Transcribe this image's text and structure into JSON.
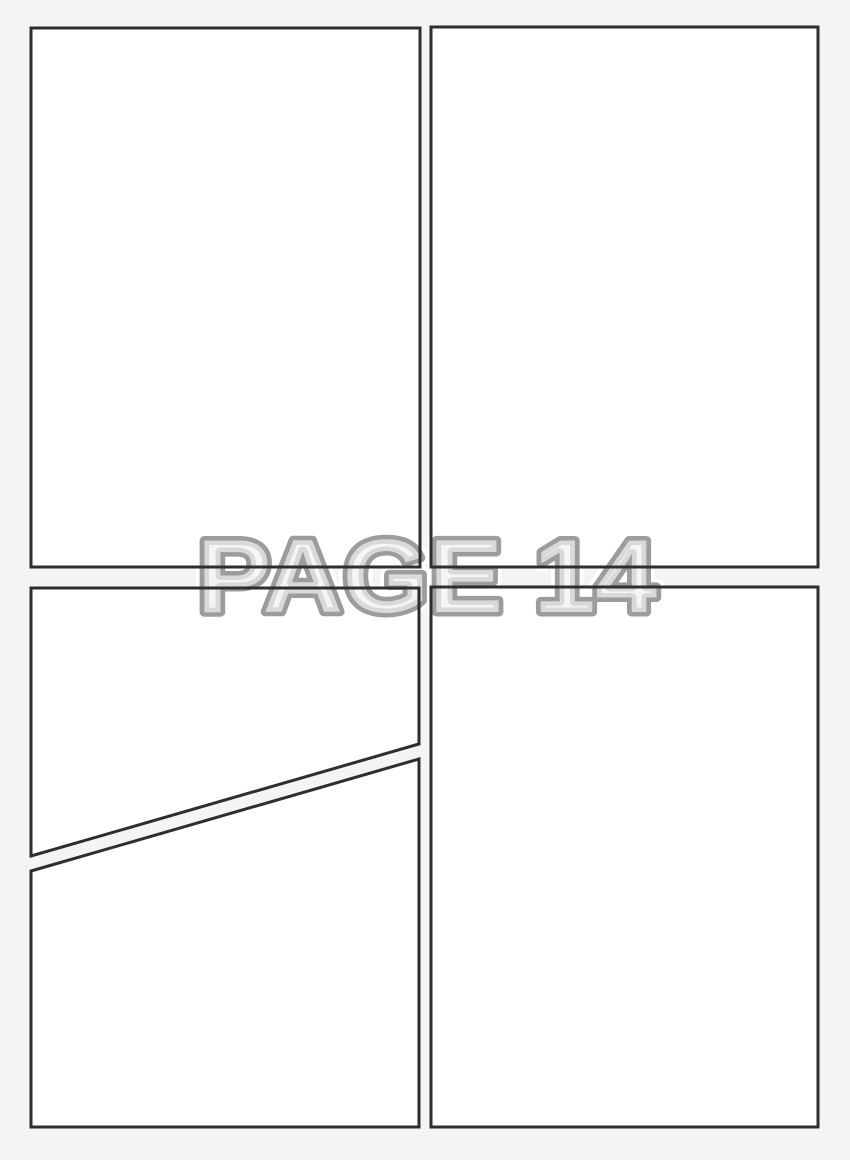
{
  "page": {
    "watermark_label": "PAGE 14",
    "colors": {
      "background": "#f4f4f4",
      "panel_fill": "#ffffff",
      "panel_border": "#2e2e2e",
      "watermark_outline": "#9c9c9c",
      "watermark_fill": "#f1f1f1",
      "watermark_halo": "#ffffff"
    }
  }
}
